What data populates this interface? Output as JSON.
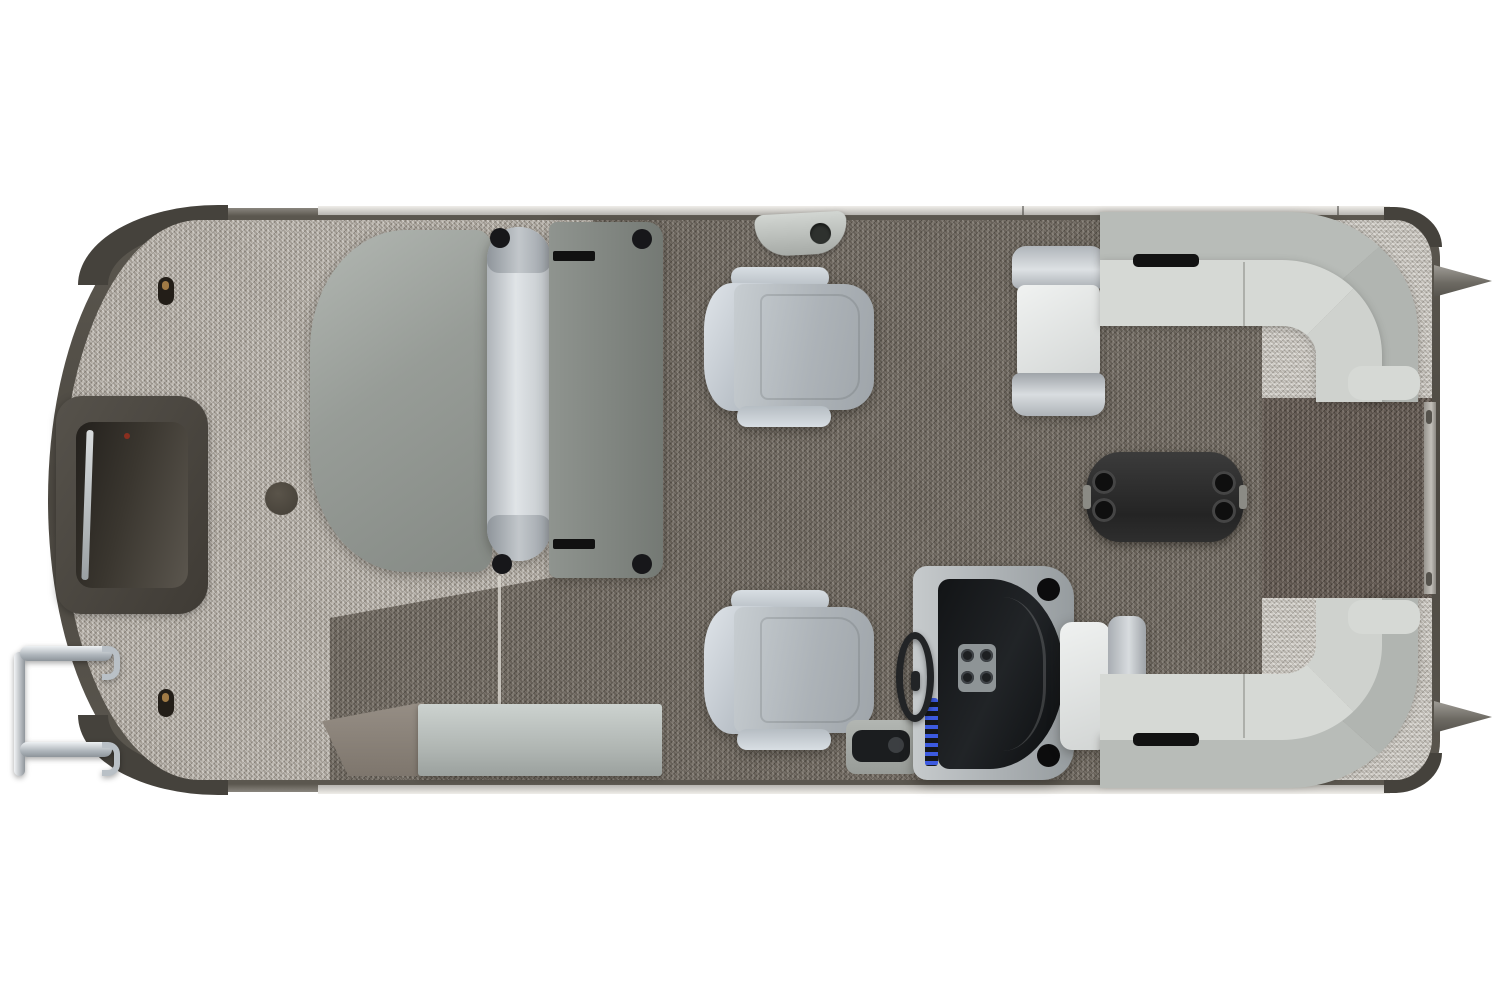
{
  "image": {
    "subject": "pontoon-boat-floorplan-overhead-render",
    "view": "top-down",
    "orientation": {
      "bow": "right",
      "stern": "left"
    }
  },
  "colors": {
    "background": "#ffffff",
    "hull_trim": "#4c4841",
    "trim_cap": "#45423c",
    "carpet_stern": "#b3ada4",
    "carpet_main": "#746d64",
    "carpet_bow": "#c6c2bb",
    "carpet_walkway": "#6b6159",
    "upholstery_light": "#f0f2f1",
    "upholstery_mid": "#b8bcb8",
    "seat_gray": "#adb3b8",
    "seat_back": "#dfe4e9",
    "bolster_silver": "#e0e4e7",
    "lounger_gray": "#979c97",
    "lounger_seat": "#7f847f",
    "table_black": "#242424",
    "console_silver": "#c6cacc",
    "dash_black": "#212427",
    "switch_blue": "#3c5ae0",
    "chrome": "#aeb5bb",
    "storage_box": "#ccd2cf",
    "storage_wedge": "#968e85",
    "gate_dark": "#3f3b35"
  },
  "components": {
    "hull": {
      "name": "Pontoon hull with rub rail trim"
    },
    "stern_deck": {
      "name": "Stern deck with light marbled carpet"
    },
    "main_deck": {
      "name": "Main deck with dark woven carpet"
    },
    "bow_deck": {
      "name": "Bow deck carpet ring"
    },
    "bow_walkway": {
      "name": "Bow walkway to front gate"
    },
    "bow_gate": {
      "name": "Bow boarding gate"
    },
    "stern_gate": {
      "name": "Stern entry gate recess"
    },
    "boarding_ladder": {
      "name": "Fold-up boarding ladder"
    },
    "rear_lounger": {
      "name": "Aft sun lounger with rolled bolster"
    },
    "ski_tow": {
      "name": "Ski tow cleat"
    },
    "port_chair": {
      "name": "Port swivel recliner chair"
    },
    "helm_chair": {
      "name": "Helm swivel chair"
    },
    "helm_console": {
      "name": "Helm console with windscreen"
    },
    "steering_wheel": {
      "name": "Steering wheel"
    },
    "throttle": {
      "name": "Throttle control"
    },
    "switch_panel": {
      "name": "Lighted rocker switch panel"
    },
    "gauge_cluster": {
      "name": "Gauge cluster"
    },
    "cocktail_table": {
      "name": "Cocktail table with four cup holders"
    },
    "port_bow_lounge": {
      "name": "Port bow wraparound lounge"
    },
    "starboard_bow_lounge": {
      "name": "Starboard bow wraparound lounge"
    },
    "port_bow_chaise": {
      "name": "Port bow recliner seat"
    },
    "starboard_bow_chaise": {
      "name": "Starboard bow recliner seat"
    },
    "storage_bench": {
      "name": "Starboard storage step bench"
    },
    "nose_cones": {
      "name": "Pontoon log nose cones"
    },
    "deck_fittings": {
      "name": "Deck keyhole fittings and table base mount"
    }
  }
}
